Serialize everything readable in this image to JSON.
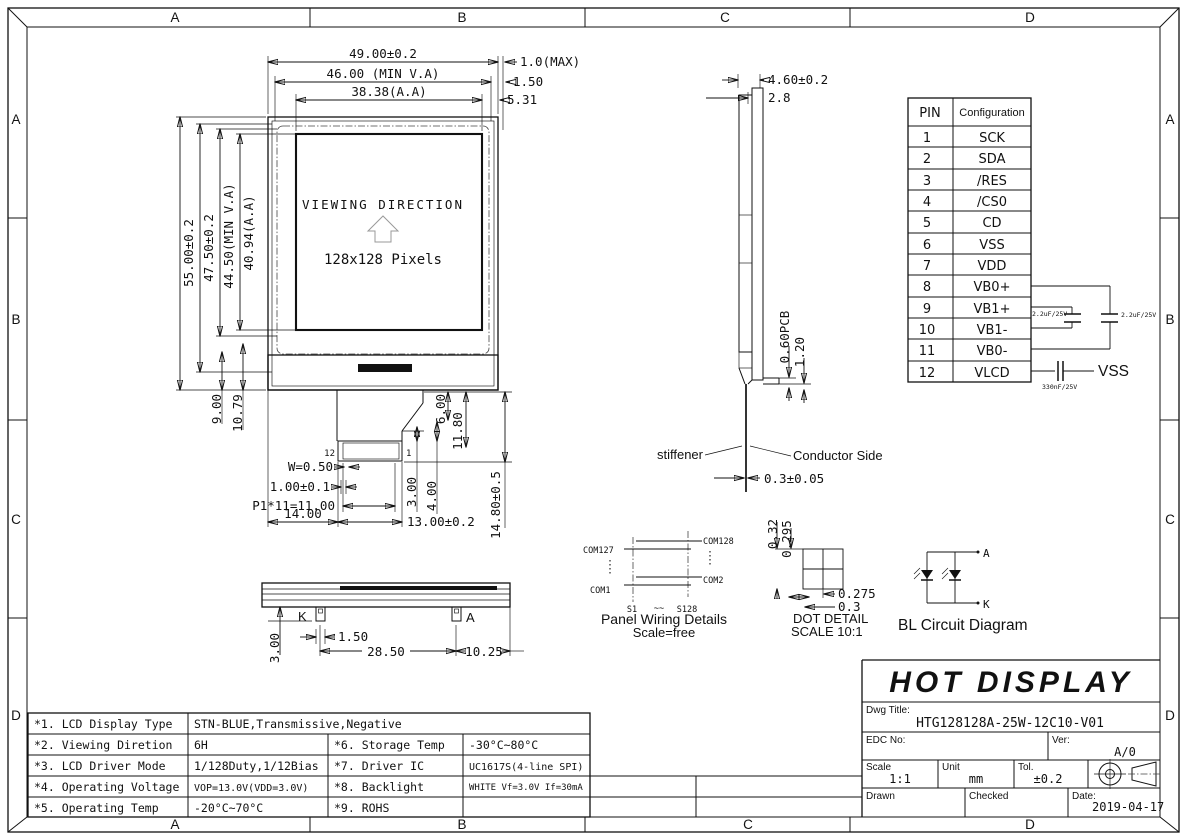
{
  "grid": {
    "cols": [
      "A",
      "B",
      "C",
      "D"
    ],
    "rows": [
      "A",
      "B",
      "C",
      "D"
    ]
  },
  "front_view": {
    "dim_w_outer": "49.00±0.2",
    "dim_w_va": "46.00 (MIN V.A)",
    "dim_w_aa": "38.38(A.A)",
    "dim_r1": "1.0(MAX)",
    "dim_r2": "1.50",
    "dim_r3": "5.31",
    "dim_h_outer": "55.00±0.2",
    "dim_h2": "47.50±0.2",
    "dim_h_va": "44.50(MIN V.A)",
    "dim_h_aa": "40.94(A.A)",
    "dim_b1": "9.00",
    "dim_b2": "10.79",
    "viewing_direction": "VIEWING DIRECTION",
    "pixels": "128x128 Pixels",
    "pin_left": "12",
    "pin_right": "1",
    "dim_c_w": "W=0.50",
    "dim_c_pitch": "1.00±0.1",
    "dim_c_span": "P1*11=11.00",
    "dim_c_14": "14.00",
    "dim_c_13": "13.00±0.2",
    "dim_c_3": "3.00",
    "dim_c_4": "4.00",
    "dim_c_6": "6.00",
    "dim_c_118": "11.80",
    "dim_c_148": "14.80±0.5"
  },
  "side_view": {
    "dim_t": "4.60±0.2",
    "dim_t2": "2.8",
    "dim_pcb": "0.60PCB",
    "dim_12": "1.20",
    "lbl_stiffener": "stiffener",
    "lbl_conductor": "Conductor Side",
    "dim_fpc": "0.3±0.05"
  },
  "pin_table": {
    "header_pin": "PIN",
    "header_cfg": "Configuration",
    "rows": [
      {
        "n": "1",
        "name": "SCK"
      },
      {
        "n": "2",
        "name": "SDA"
      },
      {
        "n": "3",
        "name": "/RES"
      },
      {
        "n": "4",
        "name": "/CS0"
      },
      {
        "n": "5",
        "name": "CD"
      },
      {
        "n": "6",
        "name": "VSS"
      },
      {
        "n": "7",
        "name": "VDD"
      },
      {
        "n": "8",
        "name": "VB0+"
      },
      {
        "n": "9",
        "name": "VB1+"
      },
      {
        "n": "10",
        "name": "VB1-"
      },
      {
        "n": "11",
        "name": "VB0-"
      },
      {
        "n": "12",
        "name": "VLCD"
      }
    ]
  },
  "cap_circuit": {
    "c1": "2.2uF/25V",
    "c2": "2.2uF/25V",
    "c3": "330nF/25V",
    "vss": "VSS"
  },
  "panel_wiring": {
    "com127": "COM127",
    "com128": "COM128",
    "com1": "COM1",
    "com2": "COM2",
    "s1": "S1",
    "tilde": "~~",
    "s128": "S128",
    "title": "Panel Wiring Details",
    "scale": "Scale=free"
  },
  "dot_detail": {
    "d_032": "0.32",
    "d_0295": "0.295",
    "d_0275": "0.275",
    "d_03": "0.3",
    "title": "DOT DETAIL",
    "scale": "SCALE 10:1"
  },
  "bl_circuit": {
    "a": "A",
    "k": "K",
    "title": "BL Circuit Diagram"
  },
  "bottom_view": {
    "k": "K",
    "a": "A",
    "d_150": "1.50",
    "d_2850": "28.50",
    "d_1025": "10.25",
    "d_300": "3.00"
  },
  "spec_table": {
    "rows": [
      {
        "c1": "*1. LCD Display Type",
        "c2": "STN-BLUE,Transmissive,Negative",
        "c3": "",
        "c4": ""
      },
      {
        "c1": "*2. Viewing Diretion",
        "c2": "6H",
        "c3": "*6. Storage Temp",
        "c4": "-30°C~80°C"
      },
      {
        "c1": "*3. LCD Driver Mode",
        "c2": "1/128Duty,1/12Bias",
        "c3": "*7. Driver IC",
        "c4": "UC1617S(4-line SPI)"
      },
      {
        "c1": "*4. Operating Voltage",
        "c2": "VOP=13.0V(VDD=3.0V)",
        "c3": "*8. Backlight",
        "c4": "WHITE Vf=3.0V If=30mA"
      },
      {
        "c1": "*5. Operating Temp",
        "c2": "-20°C~70°C",
        "c3": "*9. ROHS",
        "c4": ""
      }
    ]
  },
  "title_block": {
    "company": "HOT DISPLAY",
    "dwg_title_label": "Dwg Title:",
    "dwg_title": "HTG128128A-25W-12C10-V01",
    "edc_label": "EDC No:",
    "ver_label": "Ver:",
    "ver": "A/0",
    "scale_label": "Scale",
    "scale": "1:1",
    "unit_label": "Unit",
    "unit": "mm",
    "tol_label": "Tol.",
    "tol": "±0.2",
    "drawn_label": "Drawn",
    "checked_label": "Checked",
    "date_label": "Date:",
    "date": "2019-04-17"
  }
}
